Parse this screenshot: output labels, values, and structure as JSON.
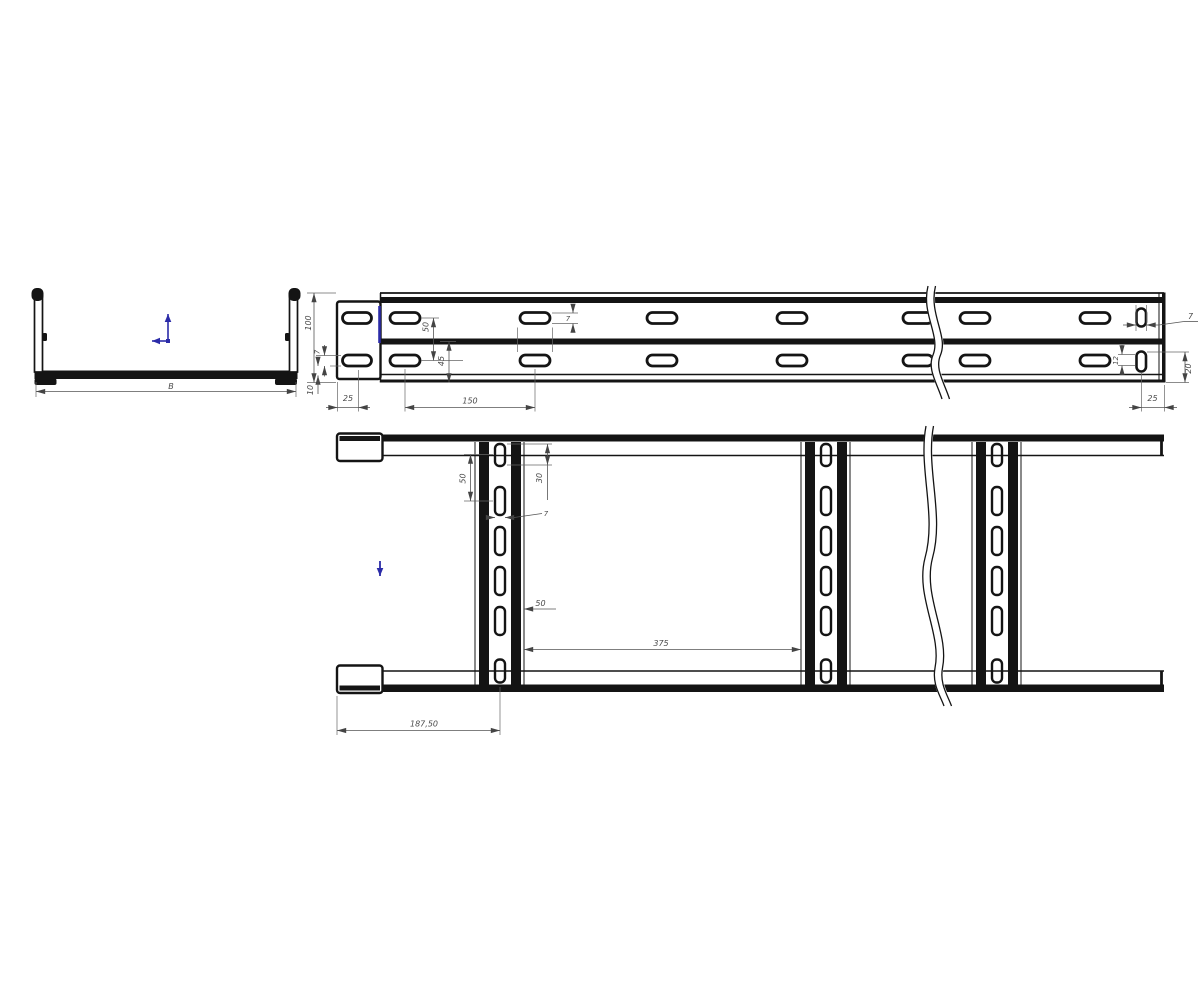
{
  "colors": {
    "line": "#141414",
    "dimension_text": "#4a4a4a",
    "accent_blue": "#2b2ba8",
    "background": "#ffffff"
  },
  "icons": {
    "origin": "origin-axes-icon",
    "z_arrow": "z-axis-arrow-icon",
    "edge_marker": "edge-highlight-icon"
  },
  "end_view": {
    "width_label": "B"
  },
  "side_view": {
    "height_100": "100",
    "row_spacing_50": "50",
    "flange_45": "45",
    "slot_height_7": "7",
    "slot_edge_7": "7",
    "bottom_offset_10": "10",
    "cap_offset_25": "25",
    "slot_pitch_150": "150",
    "end_hole_width_7": "7",
    "end_hole_height_12": "12",
    "end_hole_offset_20": "20",
    "end_offset_25": "25"
  },
  "plan_view": {
    "slot_spacing_50": "50",
    "slot_length_30": "30",
    "slot_width_7": "7",
    "rung_width_50": "50",
    "rung_pitch_375": "375",
    "first_rung_offset": "187,50"
  }
}
